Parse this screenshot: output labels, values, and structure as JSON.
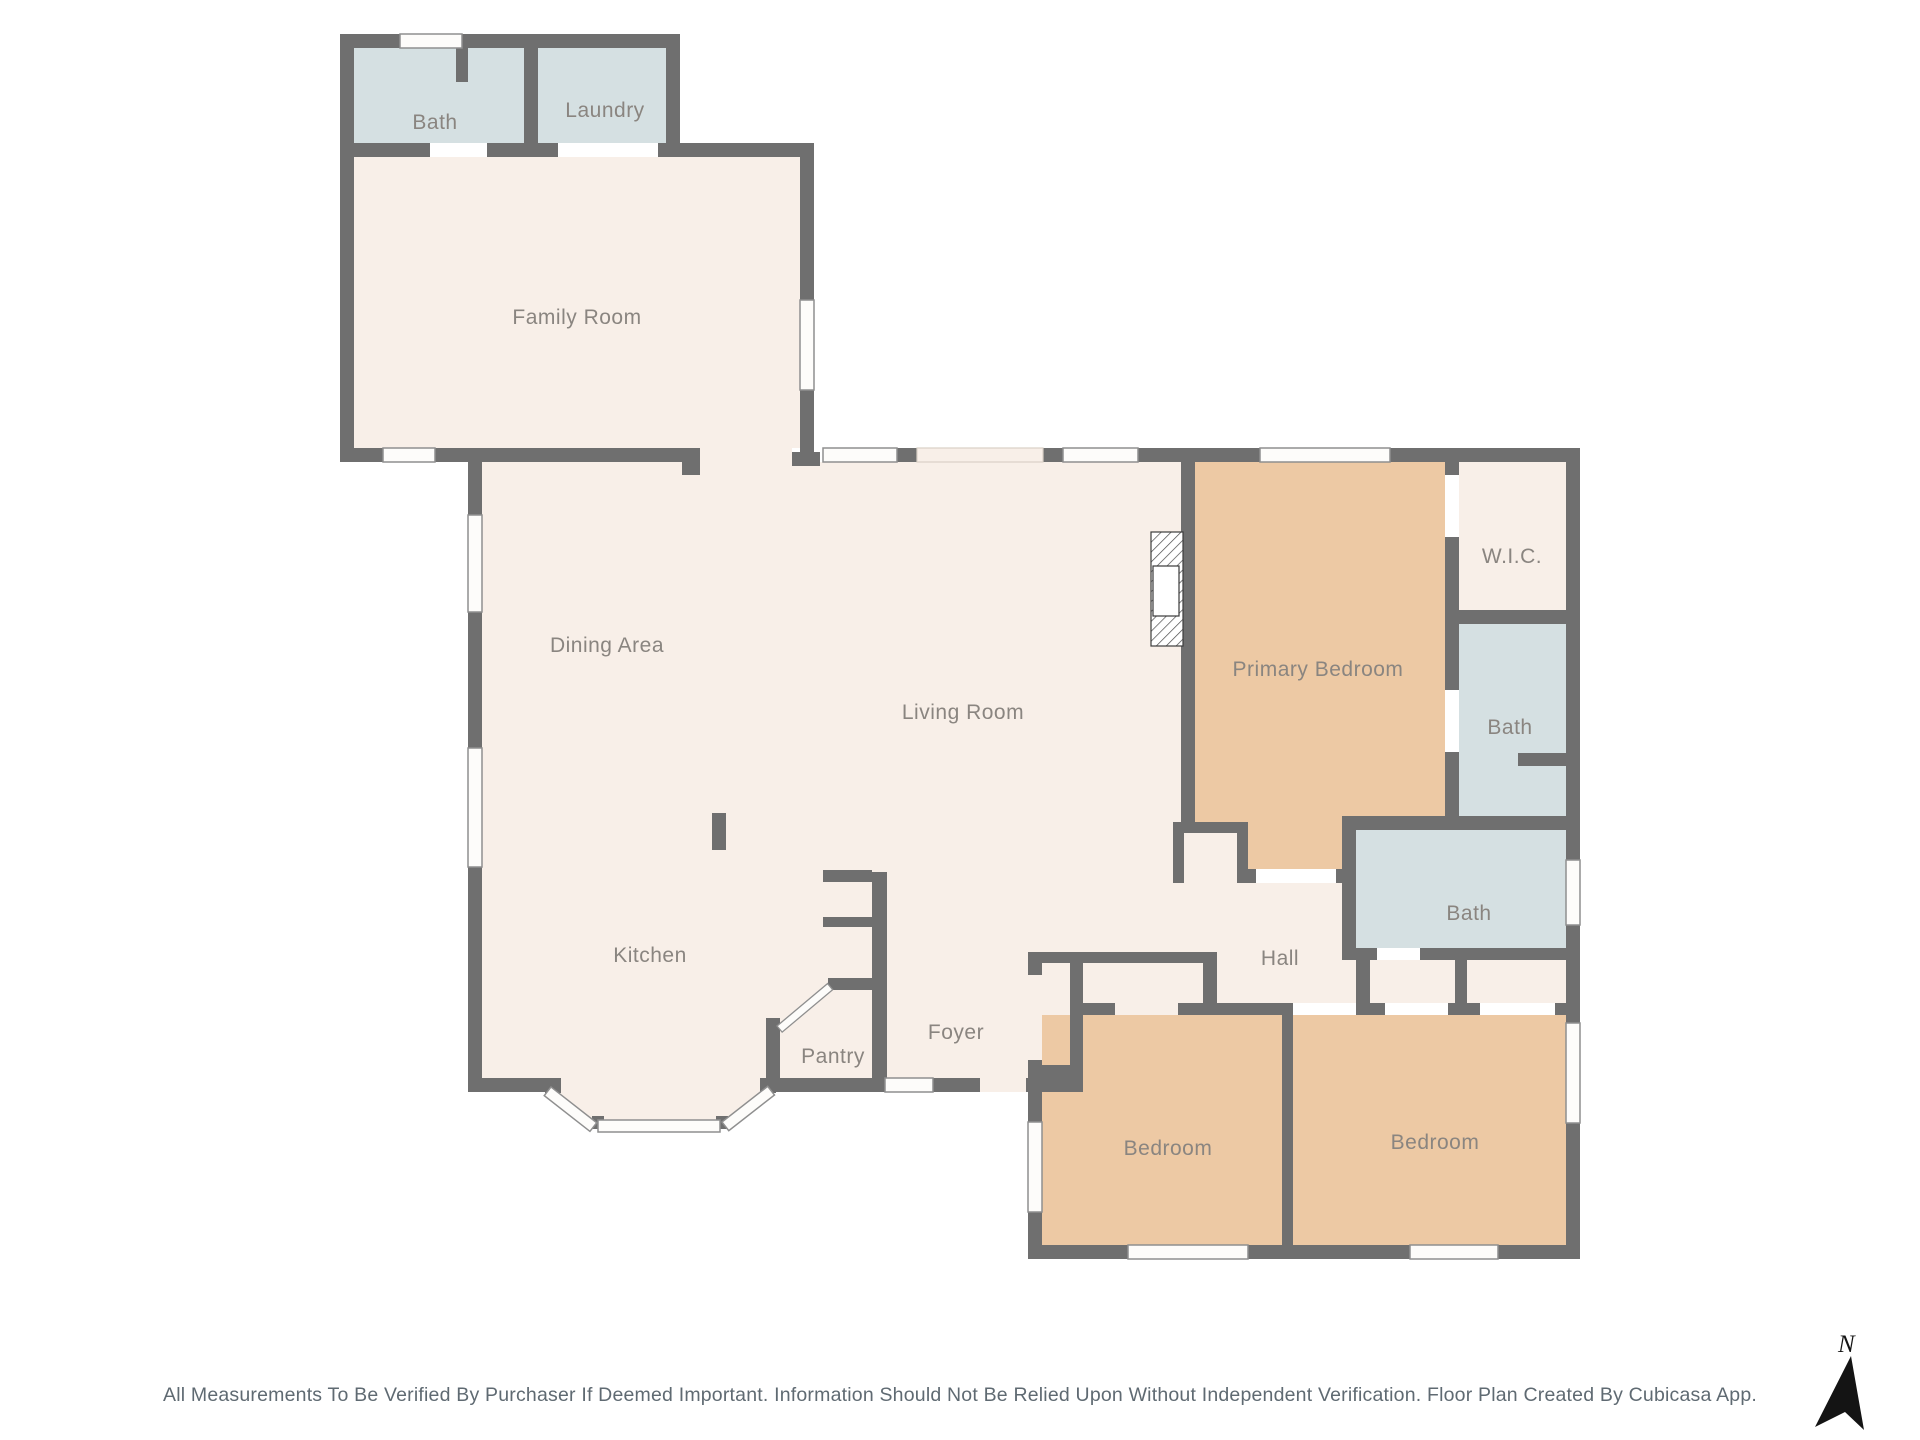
{
  "plan": {
    "rooms": [
      {
        "id": "bath-upper",
        "label": "Bath",
        "type": "wet"
      },
      {
        "id": "laundry",
        "label": "Laundry",
        "type": "wet"
      },
      {
        "id": "family-room",
        "label": "Family Room",
        "type": "default"
      },
      {
        "id": "dining-area",
        "label": "Dining Area",
        "type": "default"
      },
      {
        "id": "living-room",
        "label": "Living Room",
        "type": "default"
      },
      {
        "id": "kitchen",
        "label": "Kitchen",
        "type": "default"
      },
      {
        "id": "pantry",
        "label": "Pantry",
        "type": "default"
      },
      {
        "id": "foyer",
        "label": "Foyer",
        "type": "default"
      },
      {
        "id": "hall",
        "label": "Hall",
        "type": "default"
      },
      {
        "id": "primary-bedroom",
        "label": "Primary Bedroom",
        "type": "bedroom"
      },
      {
        "id": "walk-in-closet",
        "label": "W.I.C.",
        "type": "default"
      },
      {
        "id": "primary-bath",
        "label": "Bath",
        "type": "wet"
      },
      {
        "id": "hall-bath",
        "label": "Bath",
        "type": "wet"
      },
      {
        "id": "bedroom-left",
        "label": "Bedroom",
        "type": "bedroom"
      },
      {
        "id": "bedroom-right",
        "label": "Bedroom",
        "type": "bedroom"
      }
    ],
    "compass": {
      "label": "N"
    },
    "footer": {
      "disclaimer": "All Measurements To Be Verified By Purchaser If Deemed Important. Information Should Not Be Relied Upon Without Independent Verification. Floor Plan Created By Cubicasa App."
    },
    "colors": {
      "wall": "#6f6f6f",
      "room_default": "#f8efe8",
      "room_wet": "#d5e0e2",
      "room_bedroom": "#edc9a4",
      "label_text": "#8a8580",
      "disclaimer_text": "#5f6a72"
    }
  }
}
